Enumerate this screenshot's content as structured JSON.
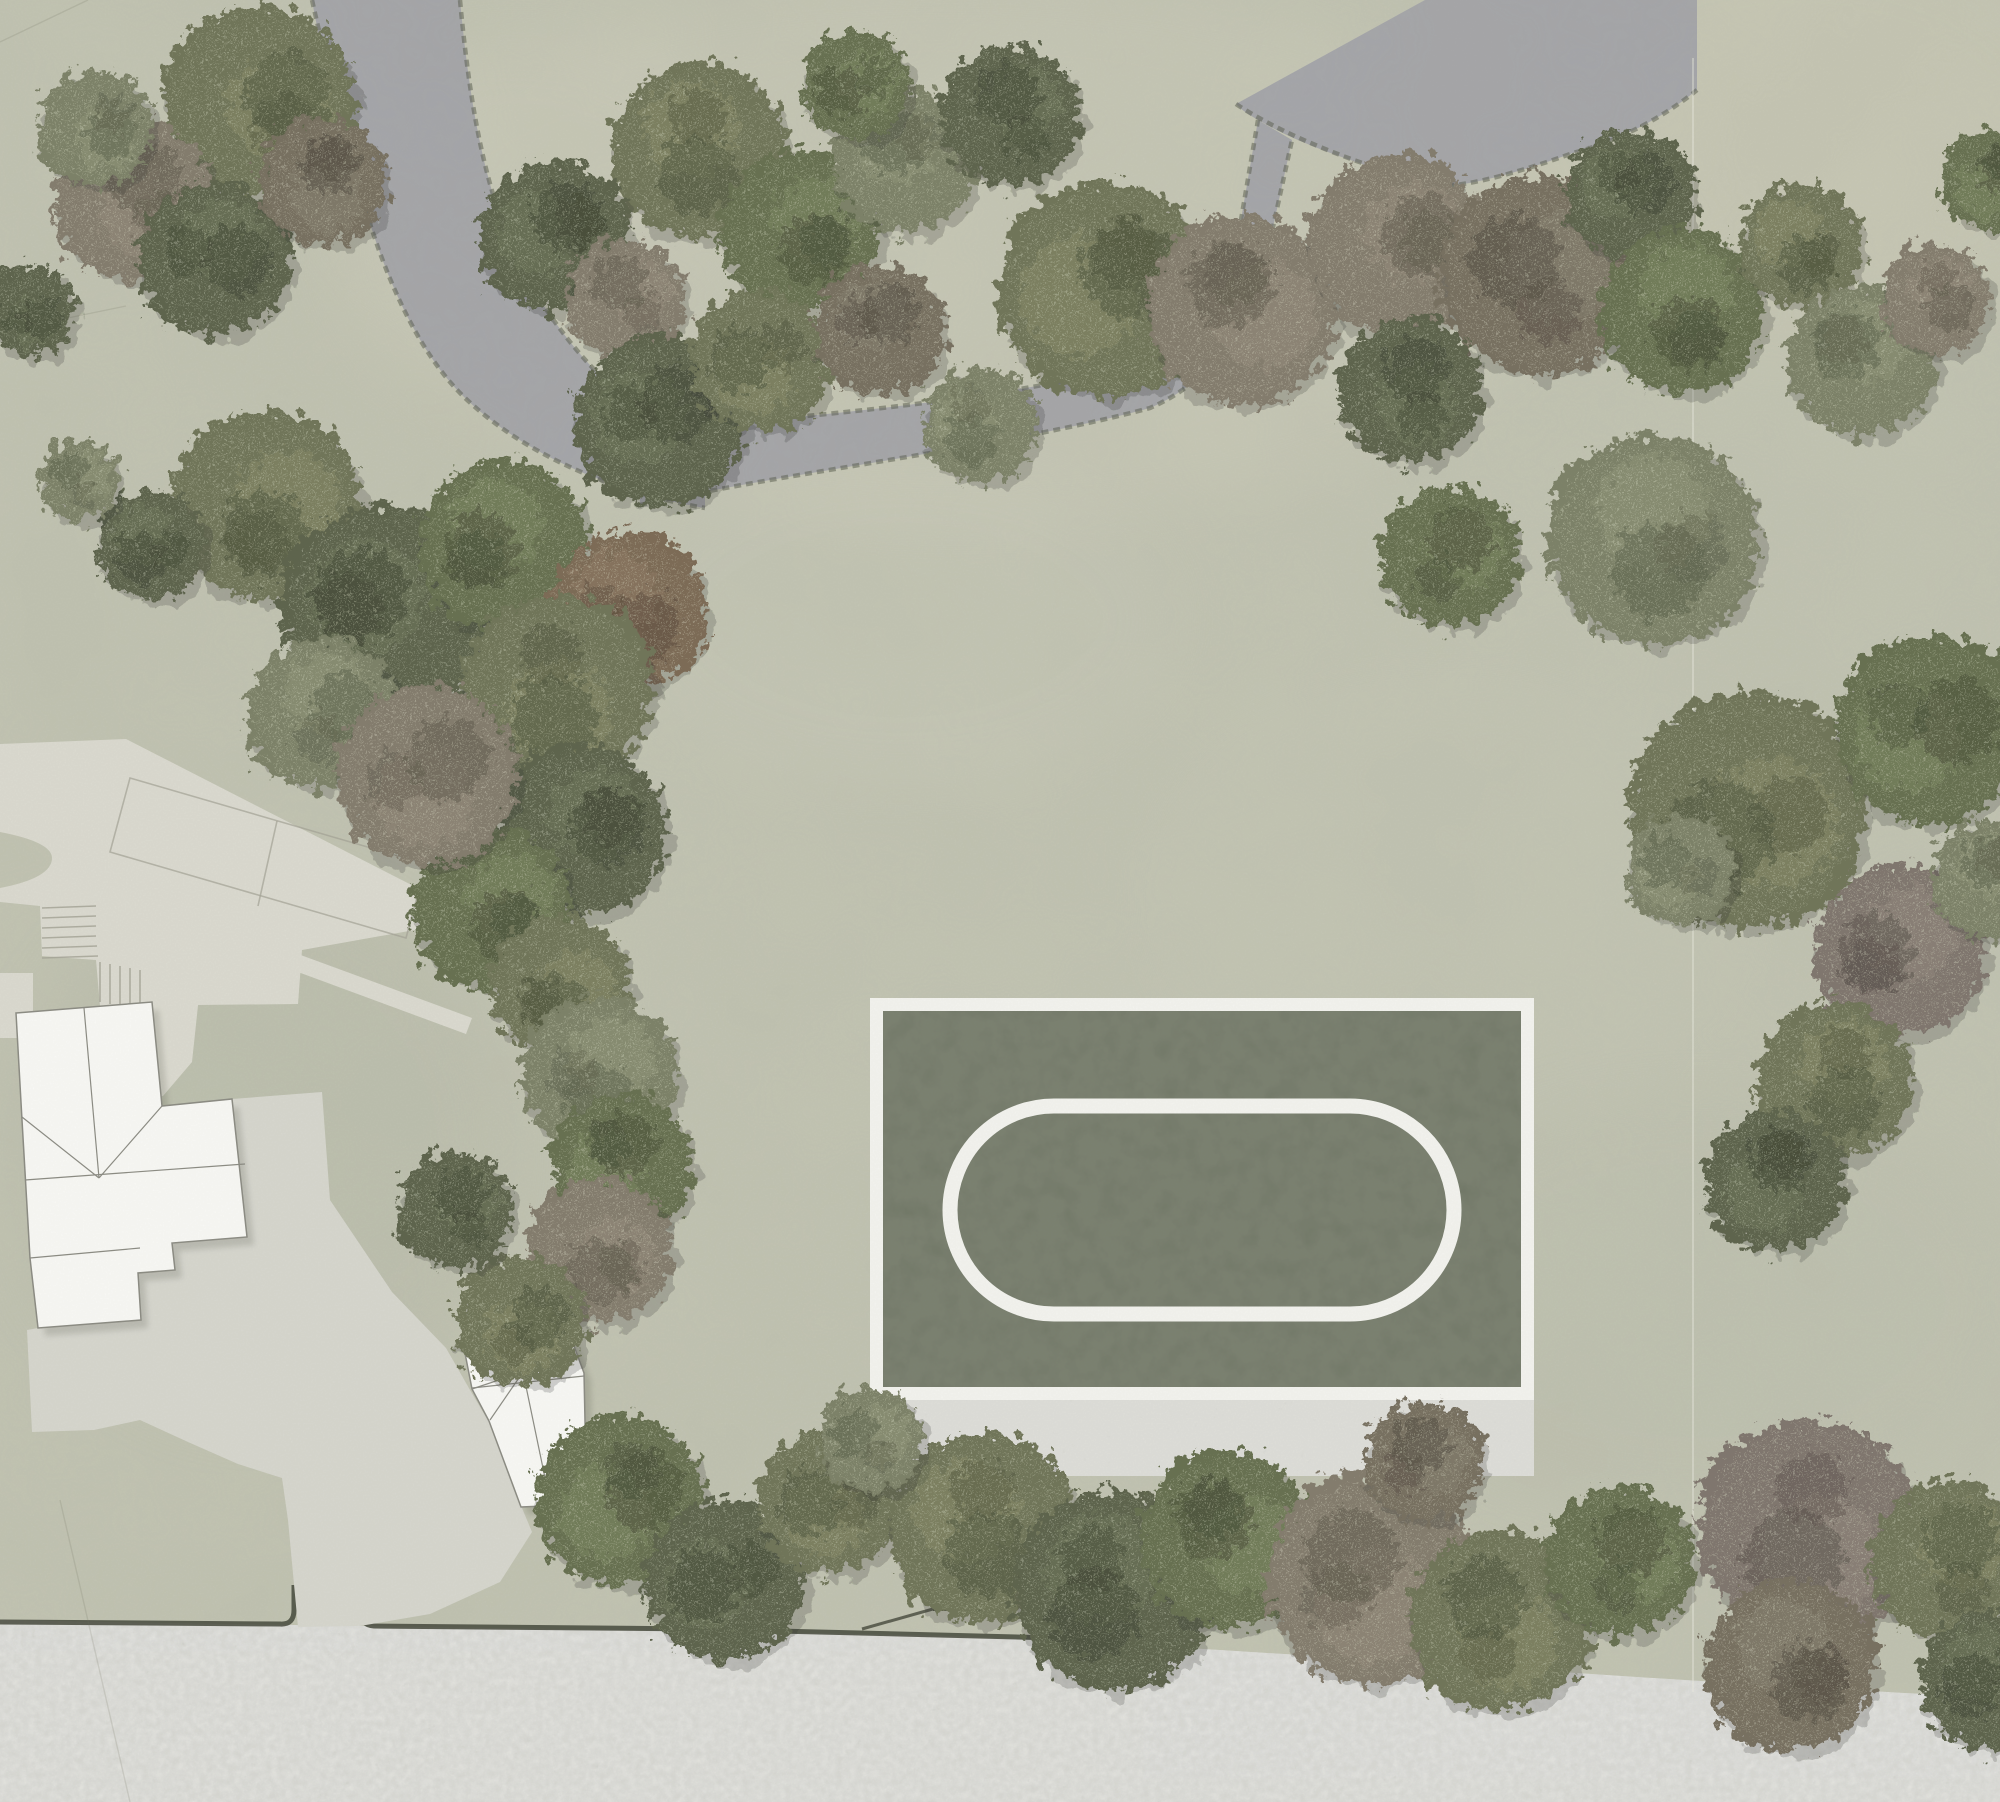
{
  "scene": {
    "width": 2000,
    "height": 1802,
    "colors": {
      "ground": "#c6c8b6",
      "path": "#a6a7ad",
      "path_edge": "#5f6254",
      "road": "#d7d7d2",
      "curb": "#43463a",
      "paving": "#deddd3",
      "apron": "#d9d9d1",
      "faint_line": "#a5a497",
      "building_fill": "#fcfcf9",
      "building_stroke": "#8c8c84",
      "shadow": "#3c4032",
      "court_frame": "#f7f7f3",
      "court_green": "#6e7464",
      "court_line": "#f7f7f3",
      "court_apron": "#d4d4ce",
      "seam": "#efefe6"
    },
    "palette": {
      "olive": {
        "base": "#6f7458",
        "dark": "#4c5239",
        "light": "#9aa07b"
      },
      "olive2": {
        "base": "#667050",
        "dark": "#454d36",
        "light": "#8f9a72"
      },
      "sage": {
        "base": "#7d8268",
        "dark": "#5a6049",
        "light": "#a3a98a"
      },
      "sagedark": {
        "base": "#5c634c",
        "dark": "#3d4431",
        "light": "#7f8765"
      },
      "brown": {
        "base": "#847c6d",
        "dark": "#5d574b",
        "light": "#a49c8c"
      },
      "brown2": {
        "base": "#776f60",
        "dark": "#514b40",
        "light": "#988f7e"
      },
      "brownpurple": {
        "base": "#80766e",
        "dark": "#584f4a",
        "light": "#a1968d"
      },
      "brownrust": {
        "base": "#7d6a55",
        "dark": "#57483a",
        "light": "#9e8a70"
      }
    },
    "tints": [
      {
        "cx": 950,
        "cy": 250,
        "rx": 620,
        "ry": 270,
        "fill": "#d9d6c4",
        "opacity": 0.22
      },
      {
        "cx": 1800,
        "cy": 140,
        "rx": 300,
        "ry": 210,
        "fill": "#d8d4be",
        "opacity": 0.28
      },
      {
        "cx": 900,
        "cy": 620,
        "rx": 280,
        "ry": 170,
        "fill": "#d6d6c6",
        "opacity": 0.18
      },
      {
        "cx": 520,
        "cy": 180,
        "rx": 210,
        "ry": 150,
        "fill": "#d8d6c6",
        "opacity": 0.18
      },
      {
        "cx": 260,
        "cy": 1150,
        "rx": 250,
        "ry": 270,
        "fill": "#b6b9a9",
        "opacity": 0.25
      },
      {
        "cx": 1700,
        "cy": 1300,
        "rx": 320,
        "ry": 210,
        "fill": "#bcbfae",
        "opacity": 0.2
      },
      {
        "cx": 1450,
        "cy": 900,
        "rx": 320,
        "ry": 240,
        "fill": "#cdcfbd",
        "opacity": 0.16
      }
    ],
    "paths": {
      "west": "M312,0 L460,0 C472,130 492,225 540,300 C585,370 640,420 705,448 L705,508 C610,492 520,452 462,395 C415,348 382,270 360,190 C345,130 322,60 312,0 Z",
      "center": "M640,430 C800,418 950,404 1080,378 C1150,362 1200,330 1235,255 L1258,120 L1292,140 L1268,250 C1248,330 1210,382 1150,408 C1000,448 800,470 640,505 Z",
      "northeast": "M1236,104 L1425,0 L1697,0 L1697,90 C1660,120 1615,142 1573,153 C1520,172 1470,186 1440,186 C1380,172 1300,145 1262,122 Q1243,112 1236,104 Z",
      "edges": [
        "M312,0 C330,80 345,140 360,190 C382,270 415,348 462,395 C520,452 610,492 705,508",
        "M460,0 C472,130 492,225 540,300 C585,370 640,420 705,448",
        "M640,430 C800,418 950,404 1080,378 C1150,362 1200,330 1235,255 L1258,120",
        "M640,505 C800,470 1000,448 1150,408 C1210,382 1248,330 1268,250 L1292,140",
        "M1236,104 C1290,140 1380,172 1440,186 C1470,186 1520,172 1573,153 C1615,142 1660,120 1697,90"
      ]
    },
    "road": {
      "shape": "M0,1620 C300,1626 700,1630 950,1636 C1250,1648 1600,1678 2000,1698 L2000,1802 L0,1802 Z",
      "curbs": [
        "M0,1622 L280,1624 Q294,1625 294,1610 L294,1585",
        "M360,1585 L360,1610 Q360,1625 374,1626 L700,1629 L1056,1638"
      ],
      "utility_square": {
        "x": 933,
        "y": 1597,
        "w": 14,
        "h": 14
      },
      "utility_line": "M940,1607 L862,1629"
    },
    "paving": {
      "terrace": "M0,744 L126,739 L437,898 L437,926 L302,950 L298,1004 L100,1006 L96,960 L42,956 L40,906 L0,902 L0,888 Q52,878 52,858 Q52,842 0,832 Z",
      "walkway": "M219,925 L472,1018 L466,1034 L214,941 Z",
      "patch_a": "M0,973 L33,973 L33,1038 L0,1038 Z",
      "patch_b": "M127,977 L186,972 L199,996 L192,1062 L163,1096 L127,1098 Z",
      "apron": "M232,1099 L322,1092 L330,1200 L392,1292 L446,1348 L470,1390 L489,1422 L522,1508 L532,1532 L500,1582 L430,1614 L360,1626 L298,1627 L288,1520 L282,1478 L238,1464 L188,1442 L140,1420 L94,1430 L32,1432 L27,1330 L38,1328 L141,1320 L138,1273 L175,1270 L172,1243 L247,1237 Z",
      "plot_lines": [
        "M130,778 L426,864 L406,938 L110,852 Z",
        "M277,821 L258,906"
      ],
      "steps": [
        [
          42,
          908,
          96,
          906
        ],
        [
          42,
          918,
          96,
          916
        ],
        [
          42,
          928,
          96,
          926
        ],
        [
          42,
          938,
          96,
          936
        ],
        [
          42,
          948,
          97,
          946
        ],
        [
          42,
          958,
          98,
          956
        ],
        [
          100,
          962,
          100,
          1002
        ],
        [
          110,
          964,
          110,
          1004
        ],
        [
          120,
          966,
          120,
          1005
        ],
        [
          130,
          968,
          130,
          1006
        ],
        [
          140,
          970,
          140,
          1007
        ]
      ],
      "seams": [
        "M1693,58 L1693,1692",
        "M0,42 L88,0",
        "M0,332 L126,306",
        "M60,1500 L130,1802"
      ]
    },
    "buildings": {
      "house": {
        "outline": "M16,1013 L152,1002 L162,1106 L232,1099 L247,1237 L172,1243 L175,1270 L138,1273 L141,1320 L38,1328 L30,1258 L22,1120 Z",
        "lines": [
          "M84,1008 L99,1178",
          "M22,1117 L99,1178",
          "M162,1106 L99,1178",
          "M25,1180 L245,1164",
          "M30,1258 L140,1248"
        ]
      },
      "outbuilding": {
        "outline": "M463,1343 L558,1303 L584,1373 L586,1470 L568,1505 L521,1507 L489,1421 L472,1389 Z",
        "lines": [
          "M472,1388 L584,1376",
          "M523,1372 L472,1389",
          "M523,1372 L490,1420",
          "M523,1372 L549,1497",
          "M523,1371 L540,1306"
        ]
      }
    },
    "court": {
      "frame": {
        "x": 870,
        "y": 998,
        "w": 664,
        "h": 402
      },
      "inner": {
        "x": 883,
        "y": 1011,
        "w": 638,
        "h": 376
      },
      "oval": {
        "cx": 1202,
        "cy": 1210,
        "rx": 252,
        "ry": 104,
        "stroke_width": 15
      },
      "apron": {
        "x": 870,
        "y": 1400,
        "w": 664,
        "h": 76
      }
    },
    "trees": [
      [
        258,
        100,
        95,
        "olive"
      ],
      [
        135,
        200,
        80,
        "brown"
      ],
      [
        95,
        128,
        58,
        "sage"
      ],
      [
        215,
        258,
        76,
        "sagedark"
      ],
      [
        322,
        182,
        64,
        "brown2"
      ],
      [
        30,
        310,
        45,
        "sagedark"
      ],
      [
        700,
        150,
        88,
        "olive"
      ],
      [
        800,
        230,
        80,
        "olive2"
      ],
      [
        905,
        160,
        72,
        "sage"
      ],
      [
        855,
        85,
        55,
        "olive2"
      ],
      [
        1010,
        115,
        70,
        "sagedark"
      ],
      [
        555,
        235,
        75,
        "sagedark"
      ],
      [
        625,
        300,
        60,
        "brown"
      ],
      [
        660,
        420,
        85,
        "sagedark"
      ],
      [
        760,
        360,
        70,
        "olive"
      ],
      [
        880,
        330,
        65,
        "brown2"
      ],
      [
        980,
        425,
        58,
        "sage"
      ],
      [
        1106,
        290,
        108,
        "olive"
      ],
      [
        1242,
        310,
        95,
        "brown"
      ],
      [
        1397,
        245,
        90,
        "brown"
      ],
      [
        1540,
        275,
        100,
        "brown2"
      ],
      [
        1630,
        195,
        65,
        "sagedark"
      ],
      [
        1682,
        310,
        82,
        "olive2"
      ],
      [
        1800,
        245,
        62,
        "olive"
      ],
      [
        1862,
        360,
        75,
        "sage"
      ],
      [
        1935,
        300,
        55,
        "brown"
      ],
      [
        1990,
        180,
        50,
        "olive2"
      ],
      [
        1410,
        390,
        72,
        "sagedark"
      ],
      [
        1449,
        556,
        70,
        "olive2"
      ],
      [
        265,
        505,
        95,
        "olive"
      ],
      [
        150,
        545,
        55,
        "sagedark"
      ],
      [
        80,
        480,
        40,
        "sage"
      ],
      [
        388,
        610,
        105,
        "sagedark"
      ],
      [
        505,
        545,
        85,
        "olive2"
      ],
      [
        628,
        610,
        78,
        "brownrust"
      ],
      [
        556,
        690,
        95,
        "olive"
      ],
      [
        323,
        712,
        75,
        "sage"
      ],
      [
        582,
        830,
        85,
        "sagedark"
      ],
      [
        492,
        906,
        80,
        "olive2"
      ],
      [
        427,
        775,
        90,
        "brown"
      ],
      [
        560,
        985,
        70,
        "olive"
      ],
      [
        600,
        1075,
        78,
        "sage"
      ],
      [
        622,
        1165,
        70,
        "olive2"
      ],
      [
        600,
        1250,
        72,
        "brown"
      ],
      [
        520,
        1320,
        65,
        "olive"
      ],
      [
        455,
        1210,
        58,
        "sagedark"
      ],
      [
        1653,
        540,
        105,
        "sage"
      ],
      [
        1746,
        810,
        118,
        "olive"
      ],
      [
        1930,
        730,
        95,
        "olive2"
      ],
      [
        1900,
        950,
        85,
        "brownpurple"
      ],
      [
        1835,
        1080,
        78,
        "olive"
      ],
      [
        1775,
        1180,
        70,
        "sagedark"
      ],
      [
        1990,
        880,
        60,
        "sage"
      ],
      [
        1680,
        870,
        55,
        "sage"
      ],
      [
        621,
        1500,
        85,
        "olive2"
      ],
      [
        725,
        1580,
        80,
        "sagedark"
      ],
      [
        830,
        1500,
        72,
        "olive"
      ],
      [
        983,
        1527,
        95,
        "olive"
      ],
      [
        1113,
        1590,
        100,
        "sagedark"
      ],
      [
        1229,
        1540,
        88,
        "olive2"
      ],
      [
        1372,
        1580,
        105,
        "brown"
      ],
      [
        1500,
        1620,
        90,
        "olive"
      ],
      [
        1620,
        1560,
        75,
        "olive2"
      ],
      [
        1810,
        1530,
        110,
        "brownpurple"
      ],
      [
        1790,
        1665,
        85,
        "brown2"
      ],
      [
        1950,
        1560,
        80,
        "olive"
      ],
      [
        1990,
        1680,
        70,
        "sagedark"
      ],
      [
        1423,
        1462,
        60,
        "brown2"
      ],
      [
        870,
        1440,
        52,
        "sage"
      ]
    ]
  }
}
